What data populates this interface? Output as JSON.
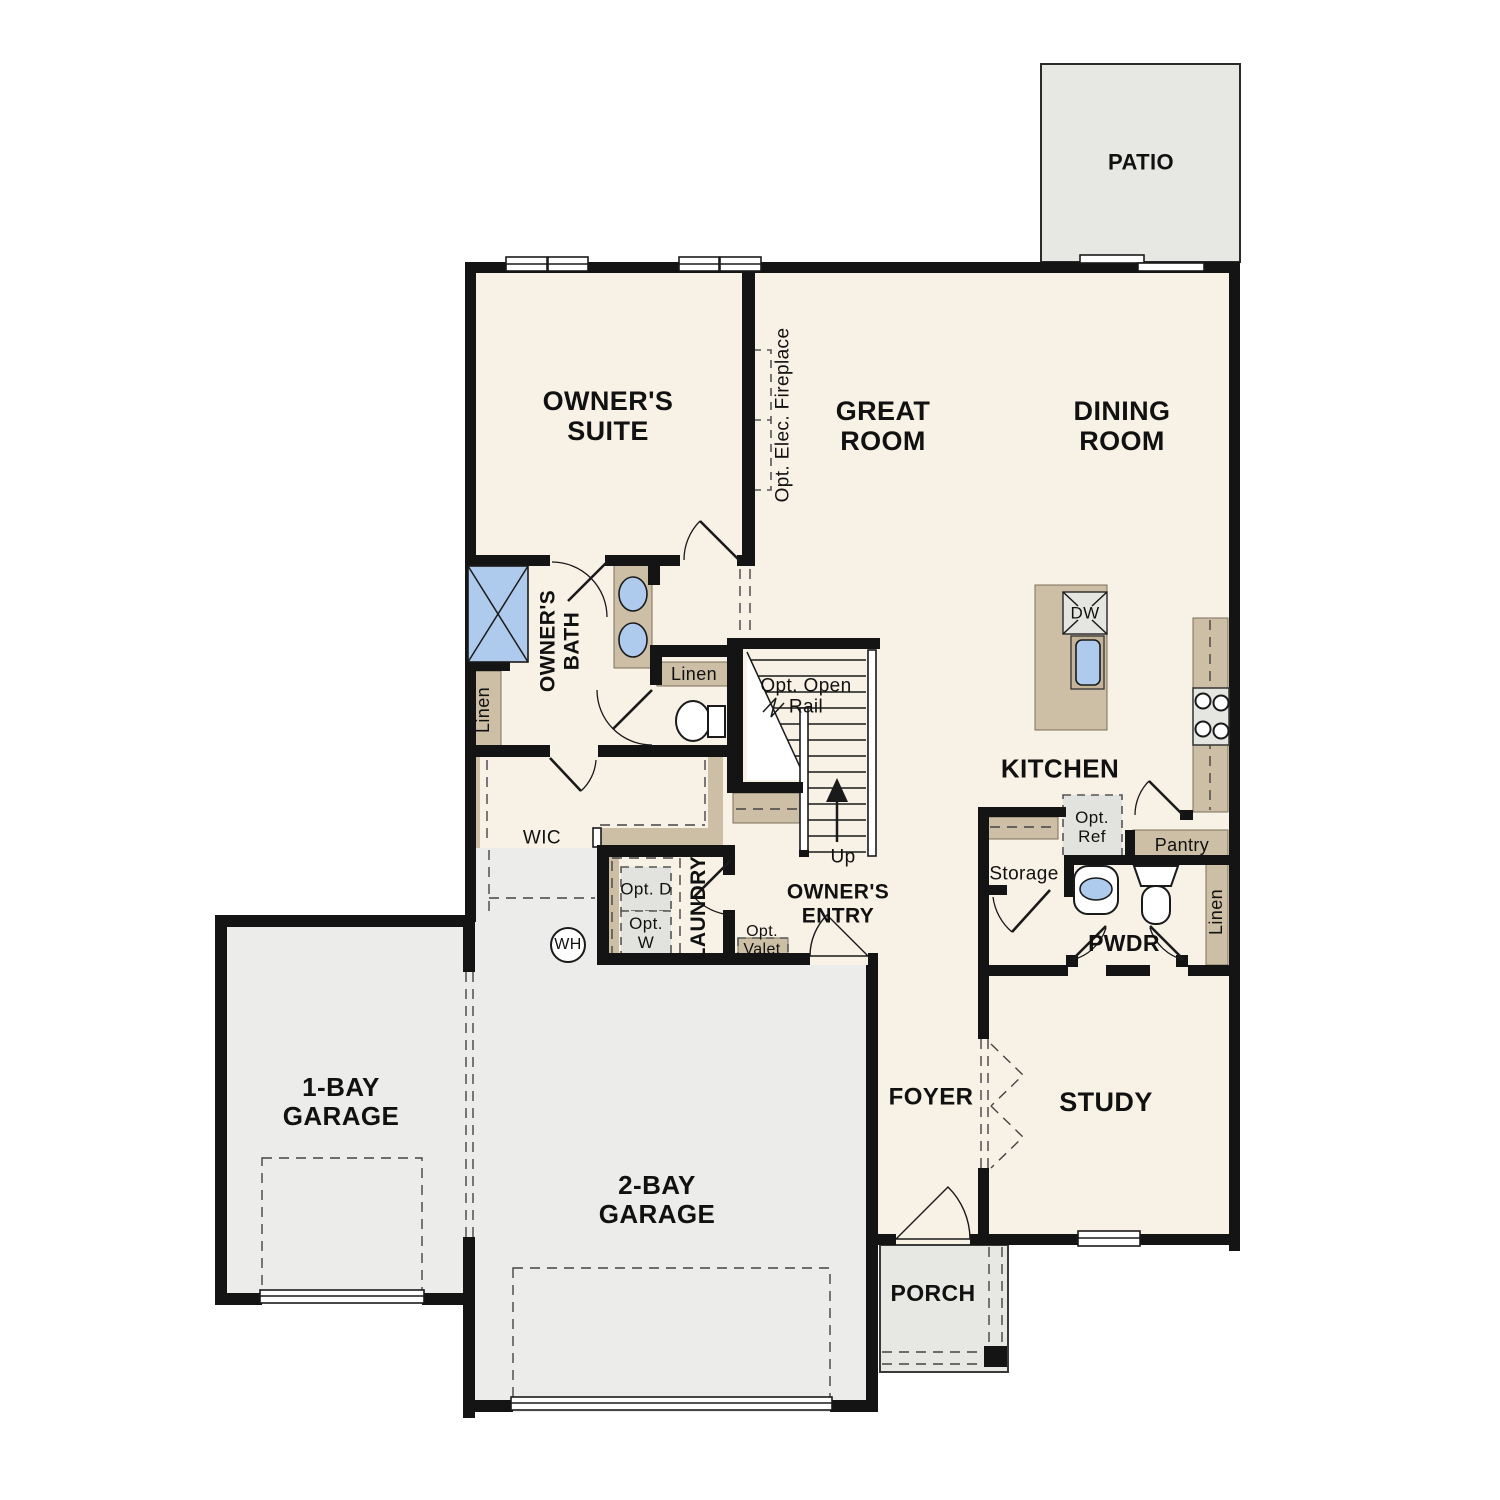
{
  "plan_title": "First floor plan",
  "labels": {
    "patio": "PATIO",
    "owners_suite": "OWNER'S SUITE",
    "great_room": "GREAT ROOM",
    "dining_room": "DINING ROOM",
    "kitchen": "KITCHEN",
    "owners_bath": "OWNER'S BATH",
    "wic": "WIC",
    "laundry": "LAUNDRY",
    "owners_entry": "OWNER'S ENTRY",
    "foyer": "FOYER",
    "study": "STUDY",
    "pwdr": "PWDR",
    "storage": "Storage",
    "pantry": "Pantry",
    "porch": "PORCH",
    "garage_1bay": "1-BAY GARAGE",
    "garage_2bay": "2-BAY GARAGE",
    "linen_left": "Linen",
    "linen_hall": "Linen",
    "linen_pwdr": "Linen",
    "opt_ref": "Opt. Ref",
    "opt_d": "Opt. D",
    "opt_w": "Opt. W",
    "opt_valet": "Opt. Valet",
    "opt_open_rail": "Opt. Open Rail",
    "opt_elec_fireplace": "Opt. Elec. Fireplace",
    "up": "Up",
    "wh": "WH",
    "dw": "DW"
  },
  "colors": {
    "interior_floor": "#f8f1e6",
    "wall": "#141414",
    "cabinet_tan": "#cdbfa6",
    "garage_floor": "#ececea",
    "patio_floor": "#e7e7e3",
    "porch_floor": "#e7e7e4",
    "fixture_blue": "#aecbee",
    "appliance_gray": "#e5e5e1"
  }
}
